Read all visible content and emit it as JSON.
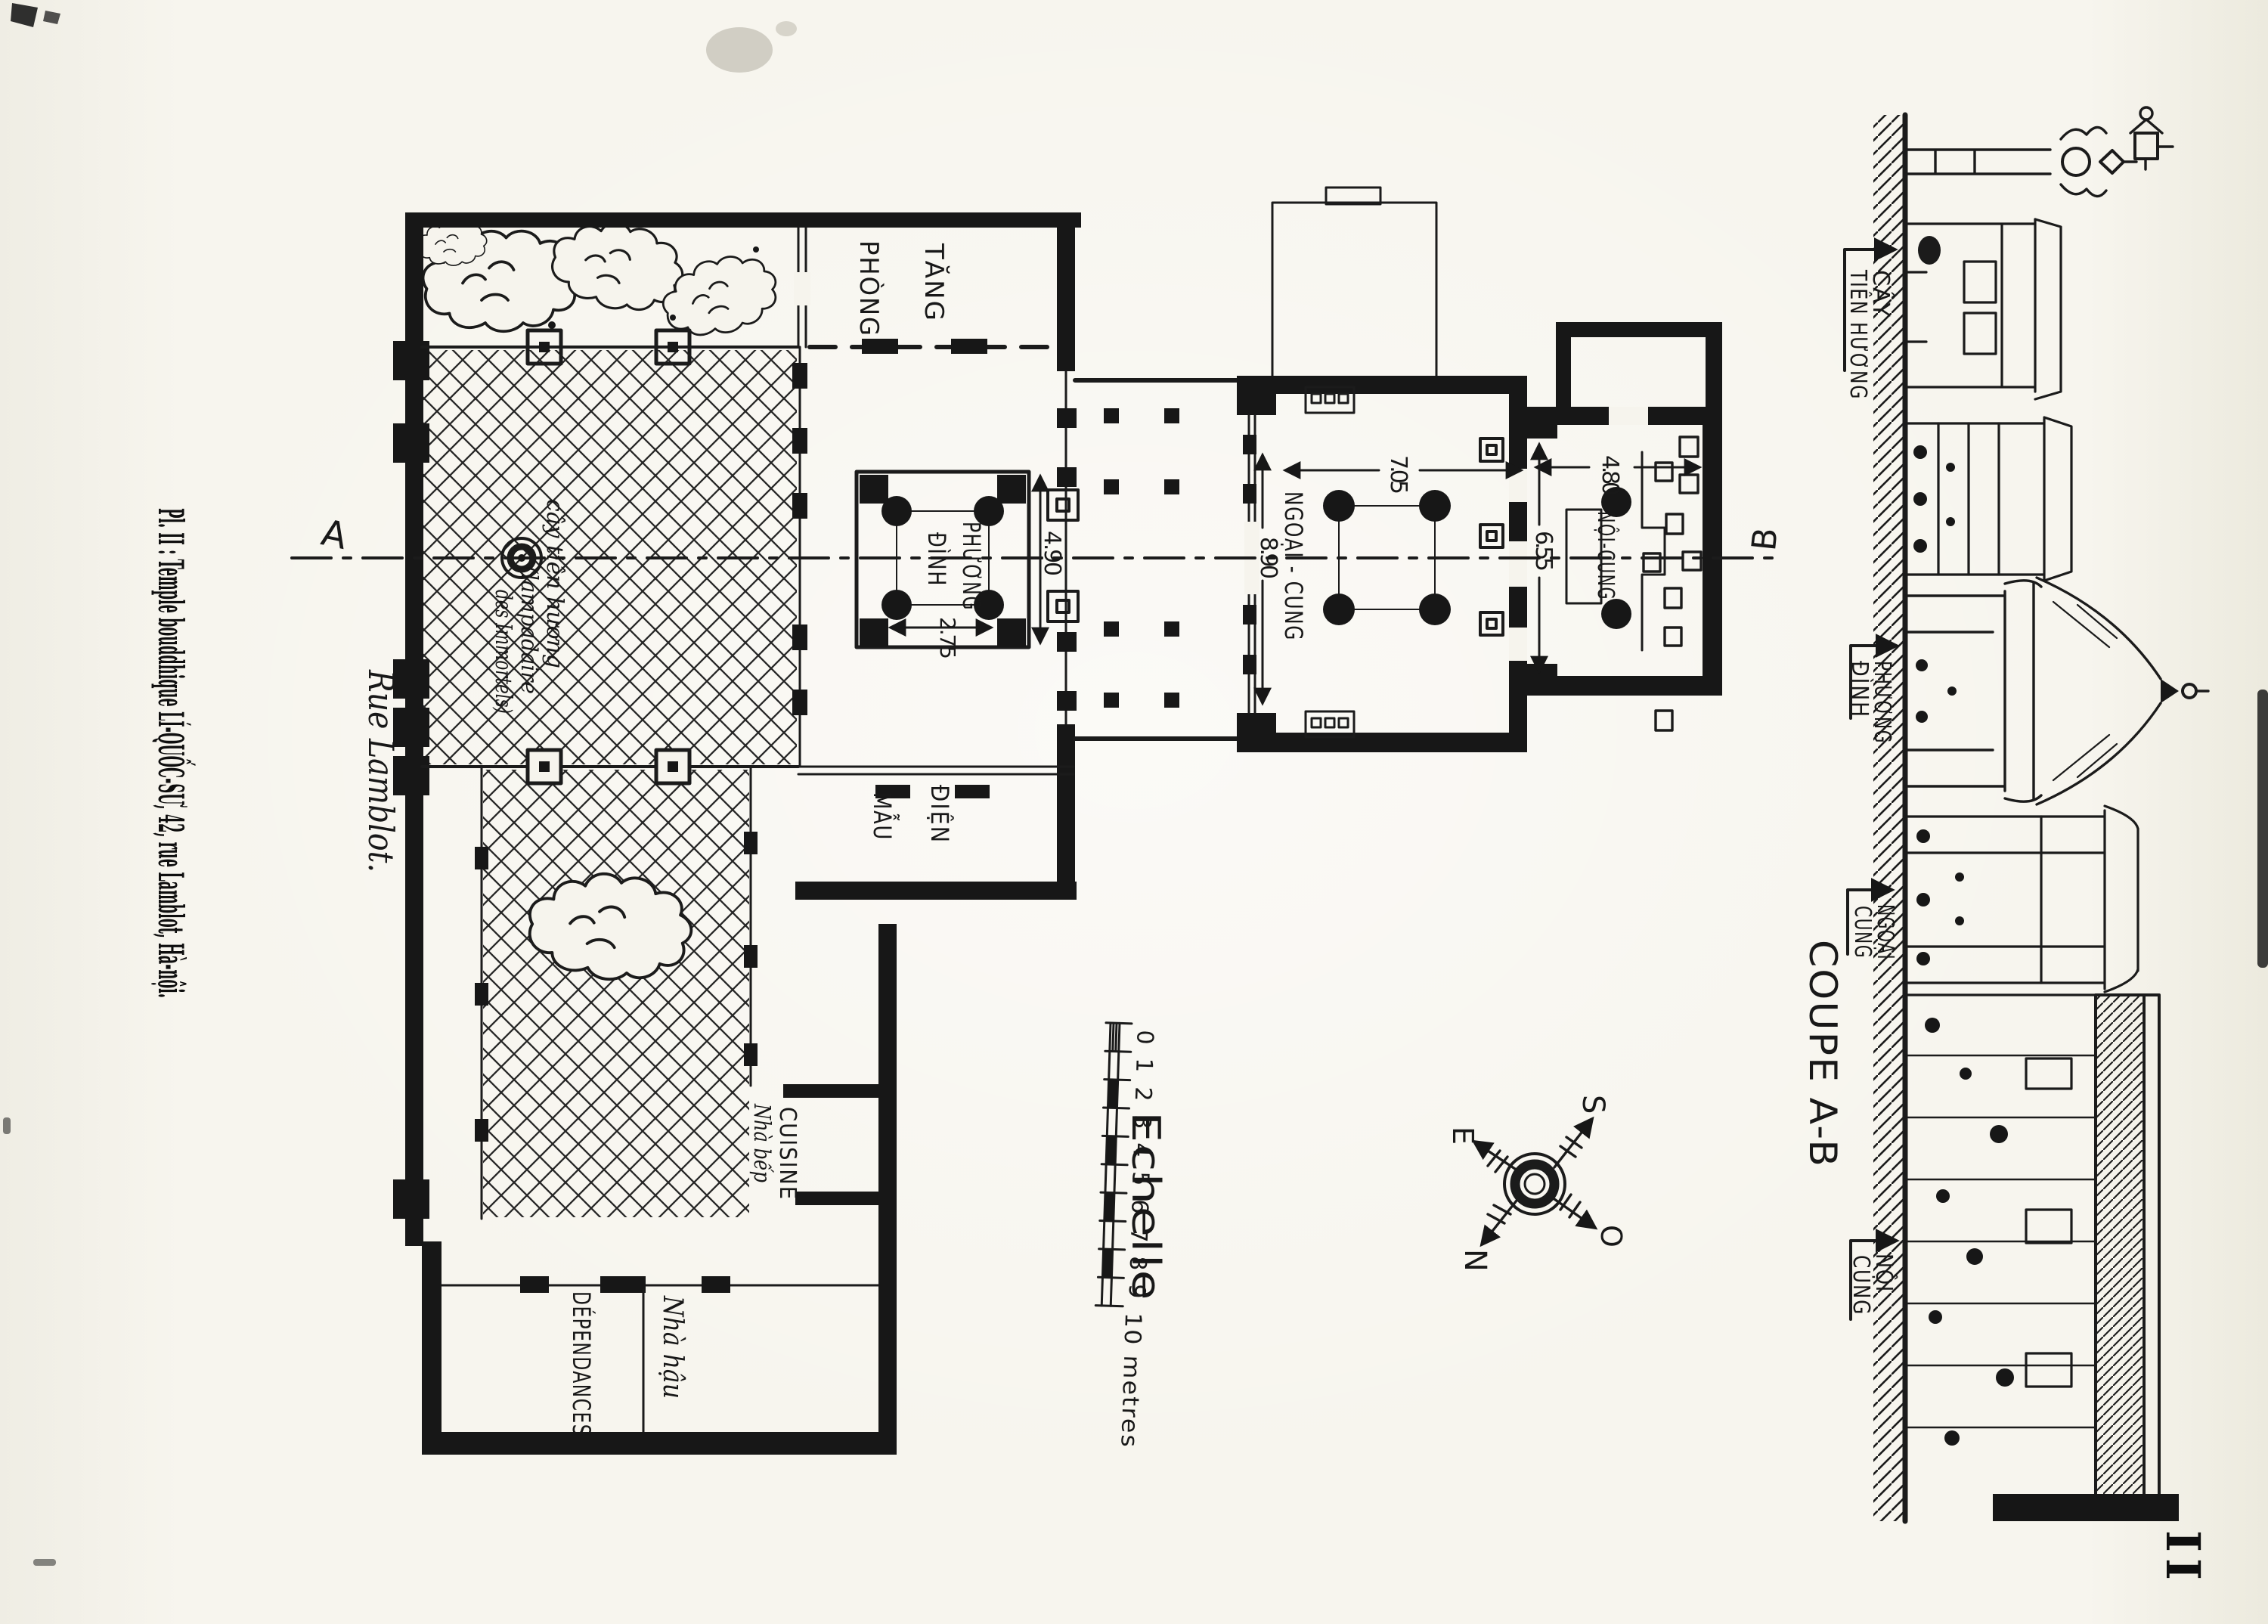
{
  "colors": {
    "paper": "#f6f4ed",
    "ink": "#1b1b1b"
  },
  "plate": {
    "title": "Pl. II :  Temple bouddhique LÍ-QUỐC-SƯ, 42, rue Lamblot, Hà-nội.",
    "page_number": "II",
    "street": "Rue Lamblot."
  },
  "plan": {
    "rooms": {
      "tang_phong": {
        "line1": "TĂNG",
        "line2": "PHÒNG"
      },
      "phuong_dinh": {
        "line1": "PHƯƠNG",
        "line2": "ĐÌNH"
      },
      "dien_mau": {
        "line1": "ĐIỆN",
        "line2": "MẪU"
      },
      "ngoai_cung": {
        "label": "NGOẠI - CUNG"
      },
      "noi_cung": {
        "label": "NỘI-CUNG"
      },
      "cuisine": {
        "label": "CUISINE",
        "sublabel": "Nhà bếp"
      },
      "dependances": {
        "label": "DÉPENDANCES",
        "sublabel": "Nhà hậu"
      }
    },
    "lamp_note": {
      "line1": "cây tiên hương",
      "line2": "(lampadaire",
      "line3": "des Immortels)"
    },
    "dimensions": {
      "phuong_dinh_width": "4.90",
      "phuong_dinh_bay": "2.75",
      "ngoai_cung_length": "8.90",
      "ngoai_cung_width": "7.05",
      "noi_cung_width": "4.80",
      "noi_cung_length": "6.55"
    },
    "markers": {
      "a": "A",
      "b": "B"
    }
  },
  "scale_bar": {
    "label": "Echelle",
    "ticks": [
      "0",
      "1",
      "2",
      "3",
      "4",
      "5",
      "6",
      "7",
      "8",
      "9"
    ],
    "end_label": "10 metres"
  },
  "compass": {
    "east": "E",
    "south": "S",
    "north": "N",
    "west": "O"
  },
  "section": {
    "title": "COUPE A-B",
    "labels": {
      "cay_tien_huong": {
        "line1": "CÂY",
        "line2": "TIÊN HƯƠNG"
      },
      "phuong_dinh": {
        "line1": "PHƯƠNG",
        "line2": "ĐÌNH"
      },
      "ngoai_cung": {
        "line1": "NGOẠI",
        "line2": "CUNG"
      },
      "noi_cung": {
        "line1": "NỘI",
        "line2": "CUNG"
      }
    }
  }
}
